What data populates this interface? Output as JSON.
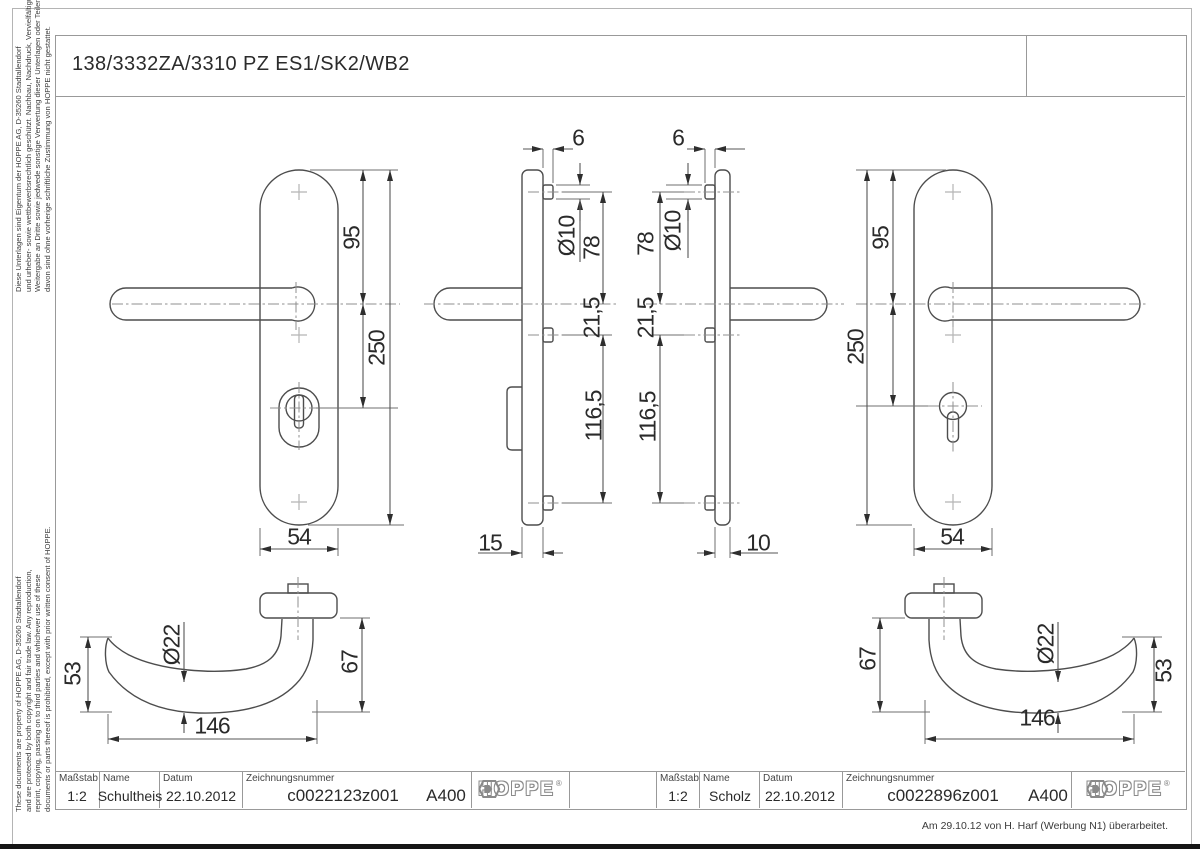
{
  "sheet": {
    "title": "138/3332ZA/3310 PZ ES1/SK2/WB2",
    "revision_note": "Am 29.10.12 von H. Harf (Werbung N1) überarbeitet.",
    "legal_de": [
      "Diese Unterlagen sind Eigentum der  HOPPE AG, D-35260 Stadtallendorf",
      "und urheber- sowie wettbewerbsrechtlich geschützt. Nachbau, Nachdruck, Vervielfältigung,",
      "Weitergabe an Dritte sowie jedwede sonstige Verwertung dieser Unterlagen oder Teilen",
      "davon sind ohne vorherige schriftliche Zustimmung von HOPPE nicht gestattet."
    ],
    "legal_en": [
      "These documents are property of HOPPE AG, D-35260 Stadtallendorf",
      "and are protected by both copyright and fair trade law. Any reproduction,",
      "reprint, copying, passing on to third parties and whichever use of these",
      "documents or parts thereof is prohibited, except with prior written consent of HOPPE."
    ]
  },
  "title_blocks": {
    "left": {
      "scale_label": "Maßstab",
      "scale_value": "1:2",
      "name_label": "Name",
      "name_value": "Schultheis",
      "date_label": "Datum",
      "date_value": "22.10.2012",
      "drawing_no_label": "Zeichnungsnummer",
      "drawing_no_value": "c0022123z001",
      "format_value": "A400",
      "brand": "HOPPE",
      "brand_reg": "®"
    },
    "right": {
      "scale_label": "Maßstab",
      "scale_value": "1:2",
      "name_label": "Name",
      "name_value": "Scholz",
      "date_label": "Datum",
      "date_value": "22.10.2012",
      "drawing_no_label": "Zeichnungsnummer",
      "drawing_no_value": "c0022896z001",
      "format_value": "A400",
      "brand": "HOPPE",
      "brand_reg": "®"
    }
  },
  "dimensions": {
    "outer_plate": {
      "top_to_handle": "95",
      "height": "250",
      "width": "54"
    },
    "outer_side": {
      "base_thickness": "6",
      "bolt_dia": "Ø10",
      "bolt_to_handle": "78",
      "handle_to_bolt": "21,5",
      "to_bottom_bolt": "116,5",
      "depth": "15"
    },
    "inner_side": {
      "base_thickness": "6",
      "bolt_dia": "Ø10",
      "bolt_to_handle": "78",
      "handle_to_bolt": "21,5",
      "to_bottom_bolt": "116,5",
      "depth": "10"
    },
    "inner_plate": {
      "top_to_handle": "95",
      "height": "250",
      "width": "54"
    },
    "handle_left": {
      "grip_height": "53",
      "grip_dia": "Ø22",
      "length": "146",
      "neck_height": "67"
    },
    "handle_right": {
      "neck_height": "67",
      "grip_dia": "Ø22",
      "grip_height": "53",
      "length": "146"
    }
  }
}
